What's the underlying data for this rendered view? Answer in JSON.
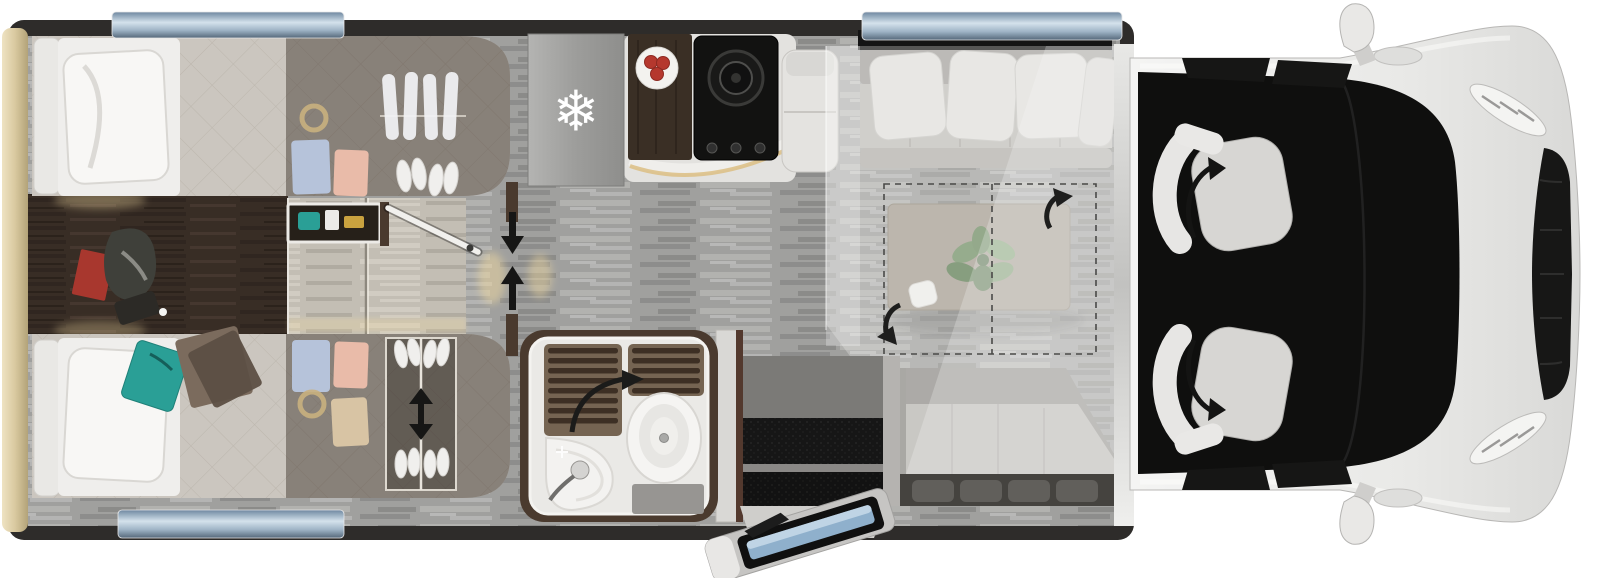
{
  "icons": {
    "fridge_snowflake": "❄"
  },
  "colors": {
    "wall": "#2e2c2a",
    "rear_wall": "#dccfa9",
    "floor": "#a0a09e",
    "bedroom_floor": "#382d25",
    "step_floor": "#c3beb4",
    "mattress": "#cbc6bf",
    "duvet": "#efeeec",
    "wardrobe_tint": "rgba(56,44,36,0.45)",
    "teal_blanket": "#2a9f96",
    "brown_blanket": "#7b6b5d",
    "red_book": "#a8372e",
    "shirt_blue": "#b6c3da",
    "shirt_pink": "#e9bba9",
    "shirt_beige": "#d8c4a4",
    "gold_trim": "#c9b07e",
    "shoe_white": "#f0efed",
    "arrow_black": "#161615",
    "glow_warm": "#f0d9a0",
    "fridge": "#a9a9a7",
    "hob": "#121211",
    "counter_wood": "#3a2f25",
    "plate": "#f3f2ef",
    "tomato": "#b5382e",
    "counter_white": "#e3e2df",
    "tv_panel": "#141414",
    "sofa_back": "#a5a3a0",
    "sofa_seat": "#c2c0bc",
    "pillow": "#e4e3e0",
    "bed_overlay": "rgba(242,242,240,0.30)",
    "table": "#a59c91",
    "plant_green": "#6f8f63",
    "bench_back": "#8e8c88",
    "bench_seat": "#b8b6b2",
    "bench_under": "#45433f",
    "wall_silver": "#c7c7c5",
    "door_mat": "#161616",
    "door_landing": "#7b7a77",
    "entry_step_body": "#c6c5c3",
    "entry_step_blue": "#8fb0cc",
    "bath_wall": "#4a3a2e",
    "bath_floor": "#eae9e6",
    "shower_base": "#756452",
    "shower_slat": "#3d2f24",
    "toilet": "#f5f4f2",
    "sink": "#f3f2f0",
    "window_glass": "#9fb4c6",
    "cab_body": "#ececea",
    "cab_glass": "#0f0f0e",
    "cab_seat": "#d7d6d3",
    "mirror": "#e9e8e6",
    "grille": "#171716"
  },
  "floorplan": {
    "view": "motorhome-top-down",
    "zones": [
      {
        "name": "rear-bedroom",
        "features": [
          "single-bed-upper",
          "single-bed-lower",
          "pillow",
          "teal-blanket",
          "brown-blanket",
          "overhead-wardrobe-upper",
          "overhead-wardrobe-lower",
          "hanging-shirts",
          "folded-clothes",
          "shoe-rack",
          "bedside-shelf",
          "partition-door",
          "red-book",
          "floor-bag"
        ]
      },
      {
        "name": "corridor",
        "features": [
          "sliding-door-arrows",
          "step-up-floor",
          "warm-lights"
        ]
      },
      {
        "name": "kitchen",
        "features": [
          "fridge-snowflake",
          "wood-worktop",
          "plate-with-tomatoes",
          "hob-burner",
          "hob-knobs",
          "led-counter-edge"
        ]
      },
      {
        "name": "washroom",
        "features": [
          "shower-slatted-floor",
          "door-swing-arrow",
          "toilet",
          "corner-sink",
          "faucet",
          "floor-mat"
        ]
      },
      {
        "name": "lounge",
        "features": [
          "tv-cabinet",
          "sofa-bench",
          "cushions",
          "pedestal-table",
          "plant",
          "cup",
          "table-rotation-arrows",
          "drop-down-bed-overlay",
          "drop-down-bed-dashed-outline",
          "side-bench"
        ]
      },
      {
        "name": "entrance",
        "features": [
          "door-frame",
          "interior-step-mats",
          "exterior-folding-step"
        ]
      },
      {
        "name": "cab",
        "features": [
          "driver-swivel-seat",
          "passenger-swivel-seat",
          "swivel-arrows",
          "windshield",
          "door-windows",
          "side-mirrors",
          "headlights",
          "grille"
        ]
      }
    ],
    "windows": [
      "rear-bed-window-top",
      "lounge-window-top",
      "lower-bed-window-bottom"
    ]
  }
}
